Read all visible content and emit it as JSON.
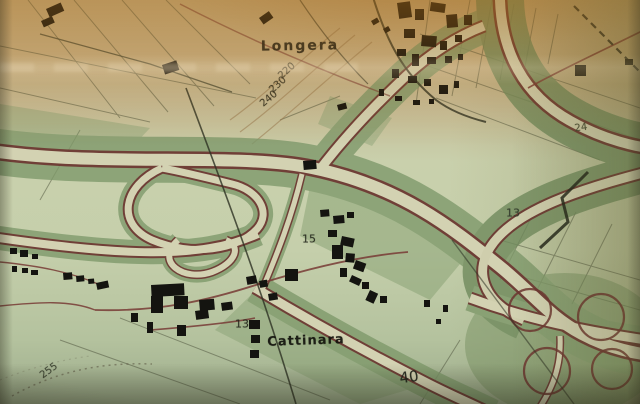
{
  "map": {
    "labels": [
      {
        "text": "Longera",
        "x": 300,
        "y": 46,
        "size": 14,
        "rot": -1,
        "color": "#20201a",
        "ls": 2
      },
      {
        "text": "Cattinara",
        "x": 306,
        "y": 341,
        "size": 13,
        "rot": -2,
        "color": "#12120c",
        "ls": 1
      },
      {
        "text": "220",
        "x": 287,
        "y": 71,
        "size": 10,
        "rot": -42,
        "color": "#2c2c1f"
      },
      {
        "text": "230",
        "x": 278,
        "y": 85,
        "size": 10,
        "rot": -42,
        "color": "#2c2c1f"
      },
      {
        "text": "240",
        "x": 269,
        "y": 99,
        "size": 10,
        "rot": -40,
        "color": "#2c2c1f"
      },
      {
        "text": "255",
        "x": 49,
        "y": 371,
        "size": 10,
        "rot": -36,
        "color": "#3a4030"
      },
      {
        "text": "15",
        "x": 309,
        "y": 239,
        "size": 11,
        "rot": 0,
        "color": "#23271c"
      },
      {
        "text": "13",
        "x": 242,
        "y": 324,
        "size": 11,
        "rot": 0,
        "color": "#23271c"
      },
      {
        "text": "13",
        "x": 513,
        "y": 213,
        "size": 11,
        "rot": 0,
        "color": "#2f372a"
      },
      {
        "text": "24",
        "x": 581,
        "y": 128,
        "size": 10,
        "rot": -8,
        "color": "#3e4530"
      },
      {
        "text": "40",
        "x": 409,
        "y": 377,
        "size": 15,
        "rot": -8,
        "color": "#1e221a"
      }
    ],
    "colors": {
      "highway_green": "#7d996a",
      "highway_green_dark": "#6e8a5c",
      "road_outline": "#6f3530",
      "road_surface": "#d8dab8",
      "building": "#141410",
      "paper_top_tan": "#c7ae7e",
      "paper_mid_sage": "#c9d0ac",
      "paper_bottom": "#9fae8d",
      "ink": "#20201a"
    }
  }
}
